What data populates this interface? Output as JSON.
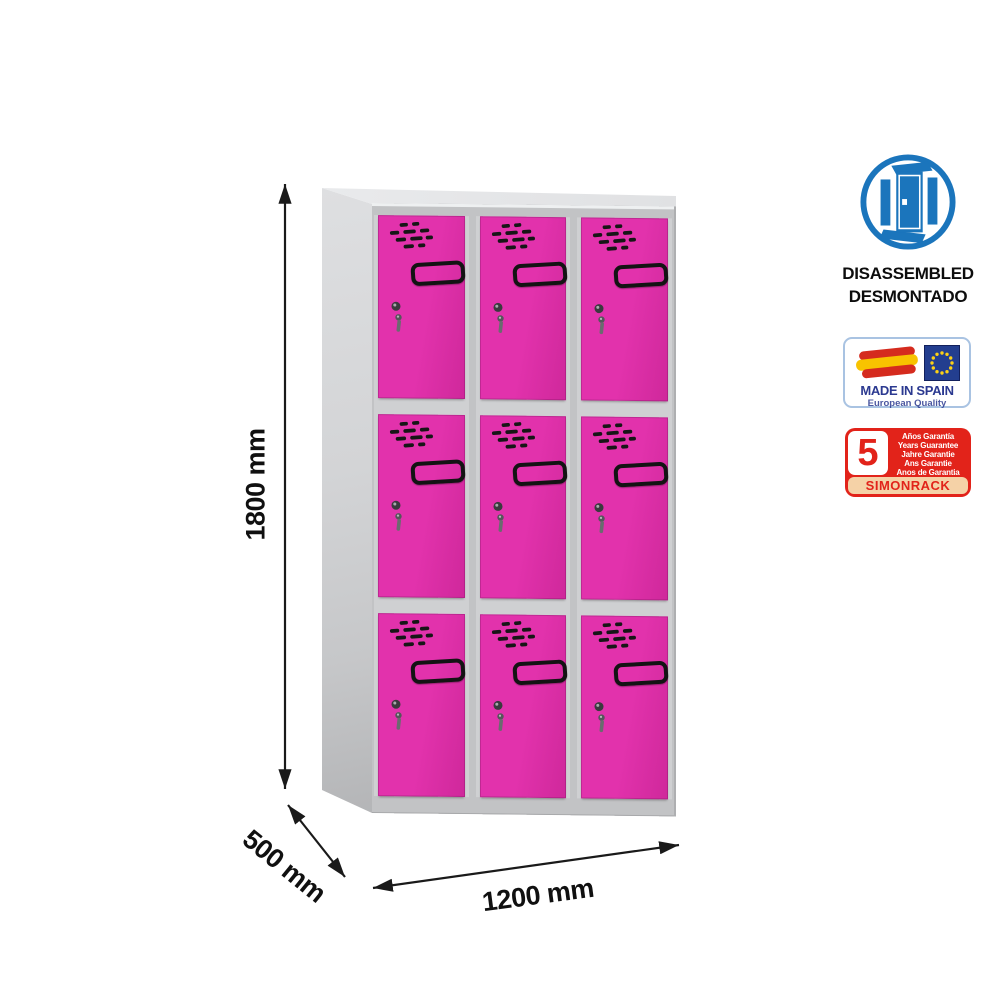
{
  "product": {
    "type": "metal locker cabinet with pink doors",
    "columns": 3,
    "rows": 3,
    "doors_total": 9,
    "door_color": "#e232ac",
    "frame_color": "#cfd0d2"
  },
  "dimensions": {
    "height": "1800 mm",
    "depth": "500 mm",
    "width": "1200 mm"
  },
  "badges": {
    "disassembled": {
      "line1": "DISASSEMBLED",
      "line2": "DESMONTADO",
      "icon": "disassembled-wardrobe-icon",
      "icon_color": "#1b75bc"
    },
    "made_in_spain": {
      "title": "MADE IN SPAIN",
      "subtitle": "European Quality",
      "icons": [
        "spain-flag-icon",
        "eu-flag-icon"
      ],
      "text_color": "#2b3990"
    },
    "guarantee": {
      "number": "5",
      "lines": [
        "Años Garantía",
        "Years Guarantee",
        "Jahre Garantie",
        "Ans Garantie",
        "Anos de Garantia"
      ],
      "brand": "SIMONRACK",
      "red": "#e2231a"
    }
  }
}
